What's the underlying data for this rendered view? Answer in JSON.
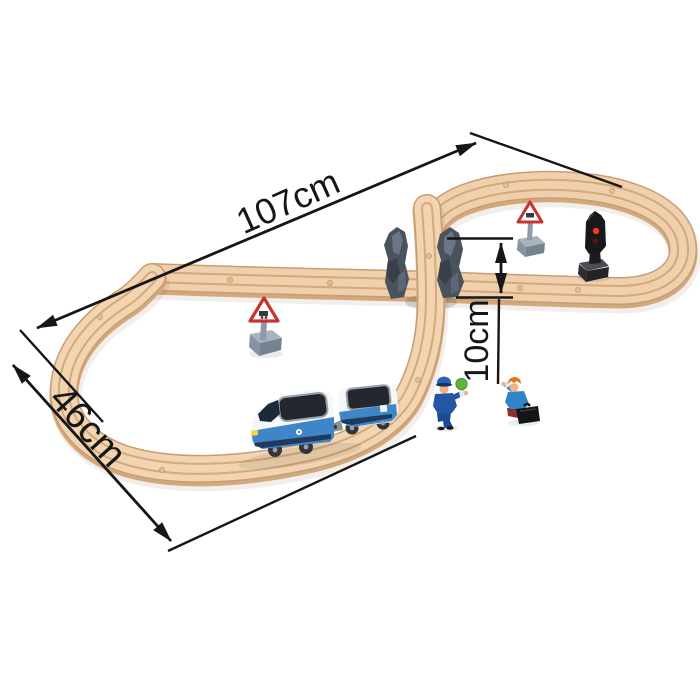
{
  "image": {
    "kind": "product-photo",
    "subject": "wooden figure-eight train set with dimension annotations",
    "background_color": "#ffffff",
    "width_px": 700,
    "height_px": 700
  },
  "annotations": {
    "arrow_color": "#161616",
    "length": {
      "label": "107cm",
      "value_cm": 107
    },
    "width": {
      "label": "46cm",
      "value_cm": 46
    },
    "bridge_height": {
      "label": "10cm",
      "value_cm": 10
    }
  },
  "scene": {
    "colors": {
      "track_wood": "#f0d0ac",
      "track_edge": "#c99d72",
      "track_groove": "#c0935f",
      "rock_support": "#4a525e",
      "train_blue": "#3e86c8",
      "train_white": "#f5f7f9",
      "train_window": "#24272d",
      "sign_gray": "#8d99a9",
      "sign_red": "#c5342e",
      "signal_black": "#17181c",
      "signal_red_light": "#ff3322",
      "paddle_green": "#5cb63a"
    },
    "objects": [
      "figure-eight wooden track",
      "rock bridge supports",
      "elevated crossing track",
      "passenger locomotive",
      "passenger coach",
      "crossing warning sign left",
      "crossing warning sign right",
      "traffic signal",
      "conductor figurine with green signal paddle",
      "traveler figurine with suitcase"
    ]
  }
}
